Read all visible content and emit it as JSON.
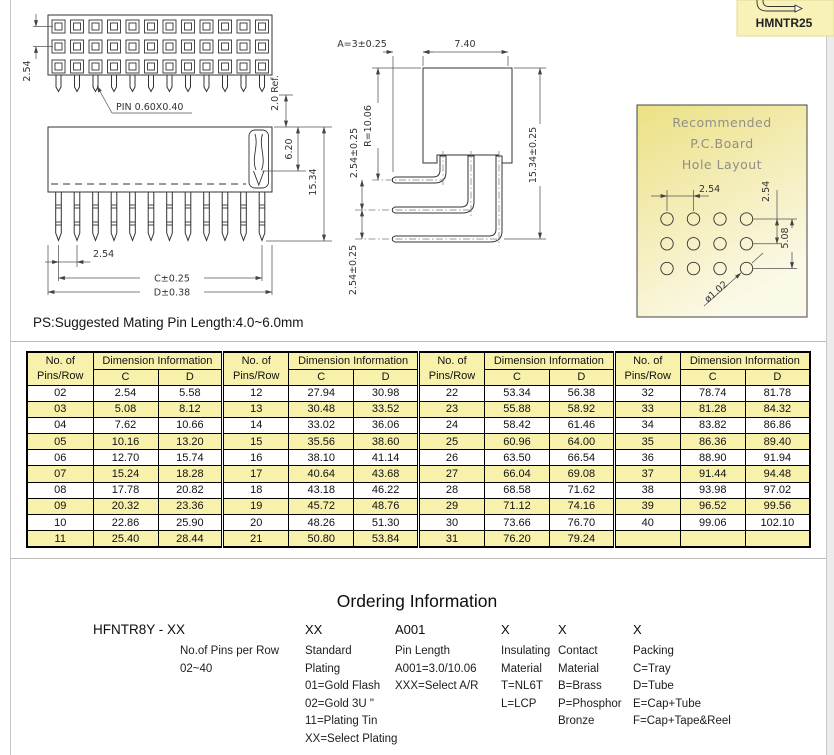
{
  "page": {
    "note": "PS:Suggested Mating Pin Length:4.0~6.0mm"
  },
  "badge": {
    "model": "HMNTR25"
  },
  "drawings": {
    "top_view": {
      "pins_per_row": 12,
      "rows": 3,
      "row_pitch": "2.54",
      "pin_label": "PIN 0.60X0.40",
      "tail_ref": "2.0 Ref."
    },
    "front_view": {
      "pitch": "2.54",
      "dim_c": "C±0.25",
      "dim_d": "D±0.38",
      "depth": "6.20",
      "height": "15.34"
    },
    "side_view": {
      "dim_a": "A=3±0.25",
      "dim_width": "7.40",
      "dim_r": "R=10.06",
      "dim_pitch_top": "2.54±0.25",
      "dim_pitch_bottom": "2.54±0.25",
      "dim_height": "15.34±0.25"
    },
    "hole_layout": {
      "title_lines": [
        "Recommended",
        "P.C.Board",
        "Hole Layout"
      ],
      "cols": 4,
      "rows": 3,
      "dim_pitch_x": "2.54",
      "dim_pitch_y": "2.54",
      "dim_span_y": "5.08",
      "dim_hole": "ø1.02"
    }
  },
  "table": {
    "header": {
      "pins_lines": [
        "No. of",
        "Pins/Row"
      ],
      "dim": "Dimension Information",
      "c": "C",
      "d": "D"
    },
    "groups": [
      [
        [
          "02",
          "2.54",
          "5.58"
        ],
        [
          "03",
          "5.08",
          "8.12"
        ],
        [
          "04",
          "7.62",
          "10.66"
        ],
        [
          "05",
          "10.16",
          "13.20"
        ],
        [
          "06",
          "12.70",
          "15.74"
        ],
        [
          "07",
          "15.24",
          "18.28"
        ],
        [
          "08",
          "17.78",
          "20.82"
        ],
        [
          "09",
          "20.32",
          "23.36"
        ],
        [
          "10",
          "22.86",
          "25.90"
        ],
        [
          "11",
          "25.40",
          "28.44"
        ]
      ],
      [
        [
          "12",
          "27.94",
          "30.98"
        ],
        [
          "13",
          "30.48",
          "33.52"
        ],
        [
          "14",
          "33.02",
          "36.06"
        ],
        [
          "15",
          "35.56",
          "38.60"
        ],
        [
          "16",
          "38.10",
          "41.14"
        ],
        [
          "17",
          "40.64",
          "43.68"
        ],
        [
          "18",
          "43.18",
          "46.22"
        ],
        [
          "19",
          "45.72",
          "48.76"
        ],
        [
          "20",
          "48.26",
          "51.30"
        ],
        [
          "21",
          "50.80",
          "53.84"
        ]
      ],
      [
        [
          "22",
          "53.34",
          "56.38"
        ],
        [
          "23",
          "55.88",
          "58.92"
        ],
        [
          "24",
          "58.42",
          "61.46"
        ],
        [
          "25",
          "60.96",
          "64.00"
        ],
        [
          "26",
          "63.50",
          "66.54"
        ],
        [
          "27",
          "66.04",
          "69.08"
        ],
        [
          "28",
          "68.58",
          "71.62"
        ],
        [
          "29",
          "71.12",
          "74.16"
        ],
        [
          "30",
          "73.66",
          "76.70"
        ],
        [
          "31",
          "76.20",
          "79.24"
        ]
      ],
      [
        [
          "32",
          "78.74",
          "81.78"
        ],
        [
          "33",
          "81.28",
          "84.32"
        ],
        [
          "34",
          "83.82",
          "86.86"
        ],
        [
          "35",
          "86.36",
          "89.40"
        ],
        [
          "36",
          "88.90",
          "91.94"
        ],
        [
          "37",
          "91.44",
          "94.48"
        ],
        [
          "38",
          "93.98",
          "97.02"
        ],
        [
          "39",
          "96.52",
          "99.56"
        ],
        [
          "40",
          "99.06",
          "102.10"
        ],
        [
          "",
          "",
          ""
        ]
      ]
    ]
  },
  "ordering": {
    "title": "Ordering Information",
    "part_code": "HFNTR8Y - XX",
    "codes": [
      "XX",
      "A001",
      "X",
      "X",
      "X"
    ],
    "columns": [
      [
        "No.of Pins per Row",
        "02~40"
      ],
      [
        "Standard",
        "Plating",
        "01=Gold Flash",
        "02=Gold 3U \"",
        "11=Plating Tin",
        "XX=Select Plating"
      ],
      [
        "Pin Length",
        "A001=3.0/10.06",
        "XXX=Select A/R"
      ],
      [
        "Insulating",
        "Material",
        "T=NL6T",
        "L=LCP"
      ],
      [
        "Contact",
        "Material",
        "B=Brass",
        "P=Phosphor",
        "Bronze"
      ],
      [
        "Packing",
        "C=Tray",
        "D=Tube",
        "E=Cap+Tube",
        "F=Cap+Tape&Reel"
      ]
    ]
  },
  "colors": {
    "table_yellow": "#F7F1AB",
    "badge_yellow": "#F8F2B8",
    "hole_box_top": "#ECE084",
    "hole_box_bottom": "#FBF9E8"
  }
}
